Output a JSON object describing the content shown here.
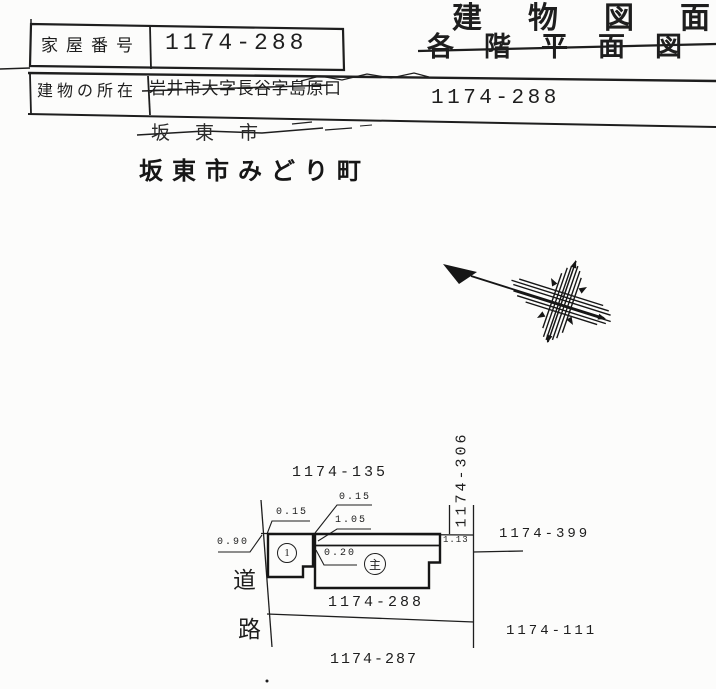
{
  "colors": {
    "ink": "#1e1e1e",
    "paper": "#fcfcfb"
  },
  "icons": {
    "north_arrow": "north-arrow-compass"
  },
  "header": {
    "title_line1": "建物図面",
    "title_line2": "各階平面図",
    "house_number_label": "家屋番号",
    "house_number_value": "1174-288",
    "location_label": "建物の所在",
    "location_old_address": "岩井市大字長谷字島原口",
    "location_number": "1174-288",
    "stamp_old_city": "坂東市",
    "stamp_new_address": "坂東市みどり町"
  },
  "plan": {
    "parcel_north": "1174-135",
    "parcel_east_strip": "1174-306",
    "parcel_northeast": "1174-399",
    "parcel_subject": "1174-288",
    "parcel_southeast": "1174-111",
    "parcel_south": "1174-287",
    "road_char_1": "道",
    "road_char_2": "路",
    "building_annex_mark": "1",
    "building_main_mark": "主",
    "dim_left_offset": "0.90",
    "dim_annex_top": "0.15",
    "dim_main_top": "0.15",
    "dim_strip": "1.05",
    "dim_gap": "0.20",
    "dim_right": "1.13"
  }
}
